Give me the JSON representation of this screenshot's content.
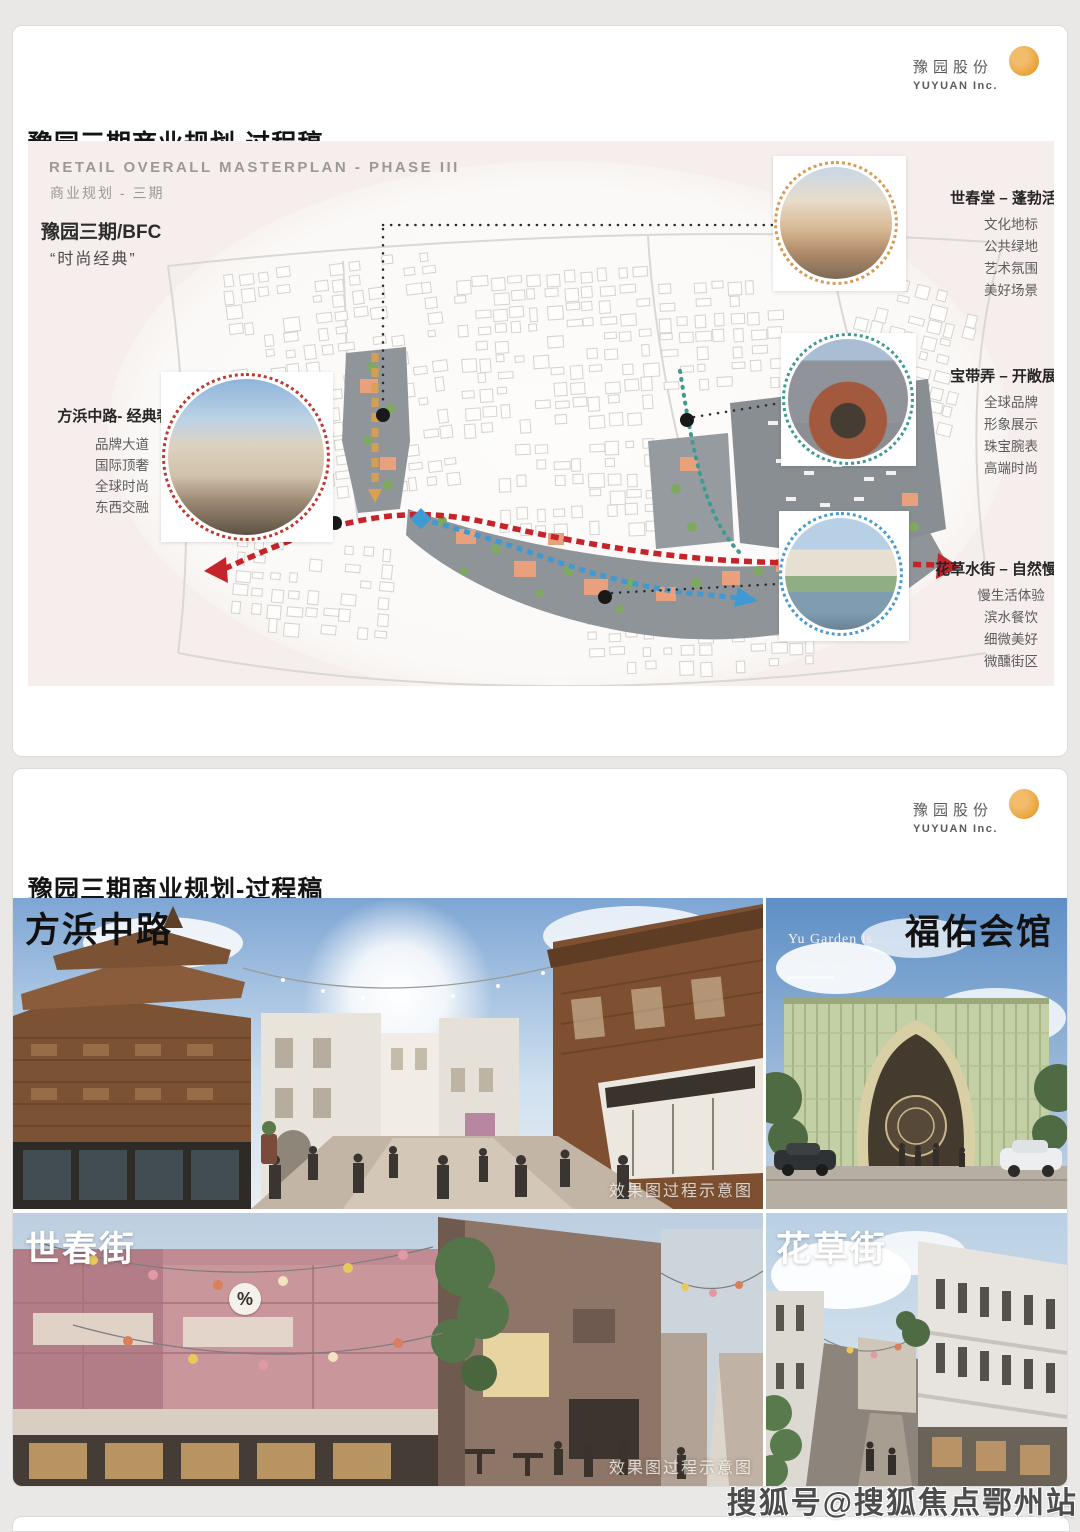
{
  "logo": {
    "cn": "豫园股份",
    "en": "YUYUAN Inc."
  },
  "watermark": "搜狐号@搜狐焦点鄂州站",
  "slide1": {
    "title": "豫园三期商业规划-过程稿",
    "plan_title_en": "RETAIL OVERALL MASTERPLAN - PHASE III",
    "plan_title_cn": "商业规划 - 三期",
    "project": "豫园三期/BFC",
    "tagline": "“时尚经典”",
    "left_callout": {
      "title": "方浜中路- 经典奢侈",
      "items": [
        "品牌大道",
        "国际顶奢",
        "全球时尚",
        "东西交融"
      ]
    },
    "right_callouts": [
      {
        "title": "世春堂 – 蓬勃活力",
        "items": [
          "文化地标",
          "公共绿地",
          "艺术氛围",
          "美好场景"
        ]
      },
      {
        "title": "宝带弄 – 开敞展示",
        "items": [
          "全球品牌",
          "形象展示",
          "珠宝腕表",
          "高端时尚"
        ]
      },
      {
        "title": "花草水街 – 自然慢生活",
        "items": [
          "慢生活体验",
          "滨水餐饮",
          "细微美好",
          "微醺街区"
        ]
      }
    ]
  },
  "slide2": {
    "title": "豫园三期商业规划-过程稿",
    "renders": [
      {
        "label": "方浜中路",
        "watermark": "效果图过程示意图"
      },
      {
        "label": "福佑会馆",
        "caption1": "Yu Garden is",
        "caption2": "Enduring"
      },
      {
        "label": "世春街",
        "sign": "%",
        "watermark": "效果图过程示意图"
      },
      {
        "label": "花草街"
      }
    ]
  },
  "colors": {
    "route_red": "#c5242b",
    "route_blue": "#3f99d4",
    "callout_orange": "#d99a55",
    "callout_teal": "#3f9a93",
    "callout_blue": "#4a9bd4",
    "logo_orange": "#e8a43c",
    "panel_pink": "#f5eeec"
  }
}
